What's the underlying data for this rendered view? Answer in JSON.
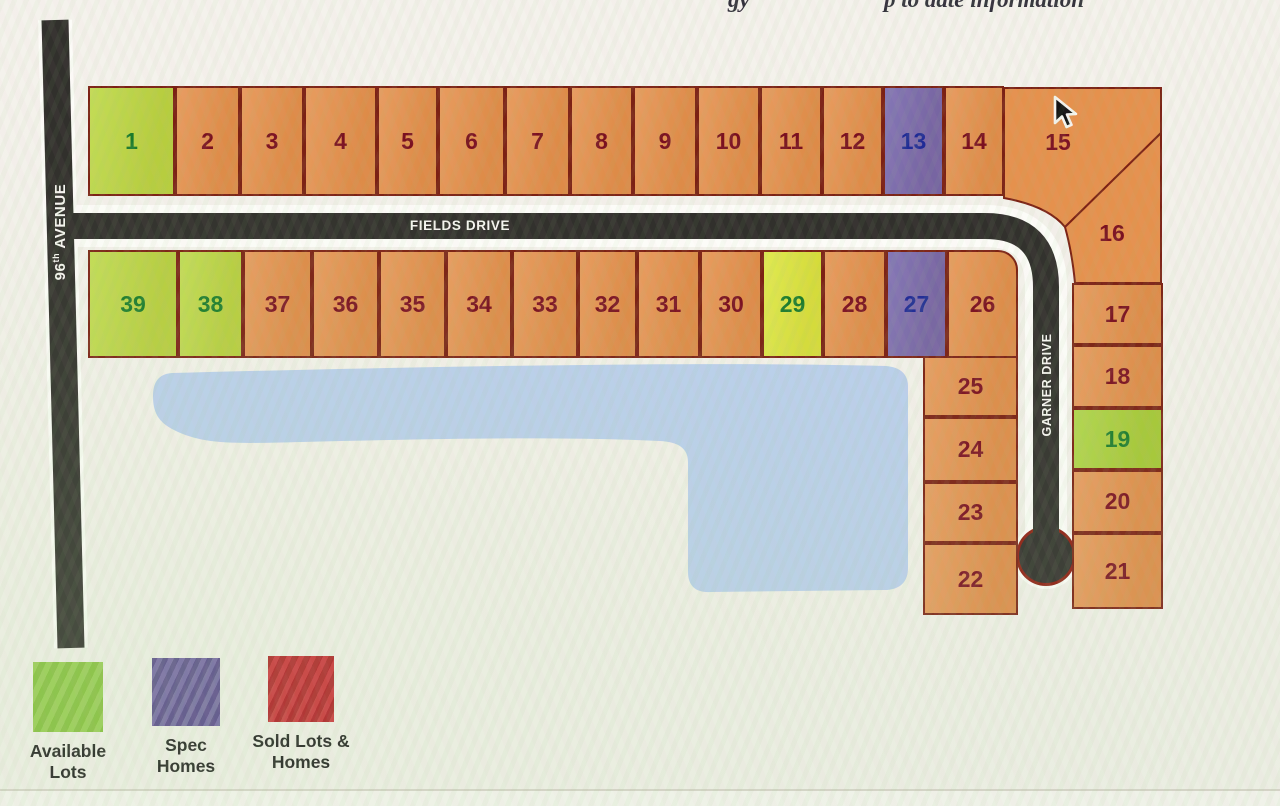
{
  "top_note": {
    "fragment1": "gy",
    "fragment2": "p to date information"
  },
  "roads": {
    "avenue": {
      "number": "96",
      "sup": "th",
      "name": " AVENUE"
    },
    "fields": {
      "name": "FIELDS DRIVE"
    },
    "garner": {
      "name": "GARNER DRIVE"
    }
  },
  "lots": [
    {
      "label": "1",
      "status": "available"
    },
    {
      "label": "2",
      "status": "default"
    },
    {
      "label": "3",
      "status": "default"
    },
    {
      "label": "4",
      "status": "default"
    },
    {
      "label": "5",
      "status": "default"
    },
    {
      "label": "6",
      "status": "default"
    },
    {
      "label": "7",
      "status": "default"
    },
    {
      "label": "8",
      "status": "default"
    },
    {
      "label": "9",
      "status": "default"
    },
    {
      "label": "10",
      "status": "default"
    },
    {
      "label": "11",
      "status": "default"
    },
    {
      "label": "12",
      "status": "default"
    },
    {
      "label": "13",
      "status": "spec"
    },
    {
      "label": "14",
      "status": "default"
    },
    {
      "label": "15",
      "status": "default"
    },
    {
      "label": "16",
      "status": "default"
    },
    {
      "label": "17",
      "status": "default"
    },
    {
      "label": "18",
      "status": "default"
    },
    {
      "label": "19",
      "status": "available"
    },
    {
      "label": "20",
      "status": "default"
    },
    {
      "label": "21",
      "status": "default"
    },
    {
      "label": "22",
      "status": "default"
    },
    {
      "label": "23",
      "status": "default"
    },
    {
      "label": "24",
      "status": "default"
    },
    {
      "label": "25",
      "status": "default"
    },
    {
      "label": "26",
      "status": "default"
    },
    {
      "label": "27",
      "status": "spec"
    },
    {
      "label": "28",
      "status": "default"
    },
    {
      "label": "29",
      "status": "available"
    },
    {
      "label": "30",
      "status": "default"
    },
    {
      "label": "31",
      "status": "default"
    },
    {
      "label": "32",
      "status": "default"
    },
    {
      "label": "33",
      "status": "default"
    },
    {
      "label": "34",
      "status": "default"
    },
    {
      "label": "35",
      "status": "default"
    },
    {
      "label": "36",
      "status": "default"
    },
    {
      "label": "37",
      "status": "default"
    },
    {
      "label": "38",
      "status": "available"
    },
    {
      "label": "39",
      "status": "available"
    }
  ],
  "legend": [
    {
      "key": "available",
      "line1": "Available",
      "line2": "Lots",
      "color": "#8cc63e"
    },
    {
      "key": "spec",
      "line1": "Spec",
      "line2": "Homes",
      "color": "#6b5ca0"
    },
    {
      "key": "sold",
      "line1": "Sold Lots &",
      "line2": "Homes",
      "color": "#c8242c"
    }
  ],
  "colors": {
    "available_lot": "#bcd843",
    "spec_lot": "#7768ae",
    "standard_lot": "#e5914d",
    "pond": "#bacfec",
    "road": "#31302c",
    "lot_border": "#7b2114"
  }
}
